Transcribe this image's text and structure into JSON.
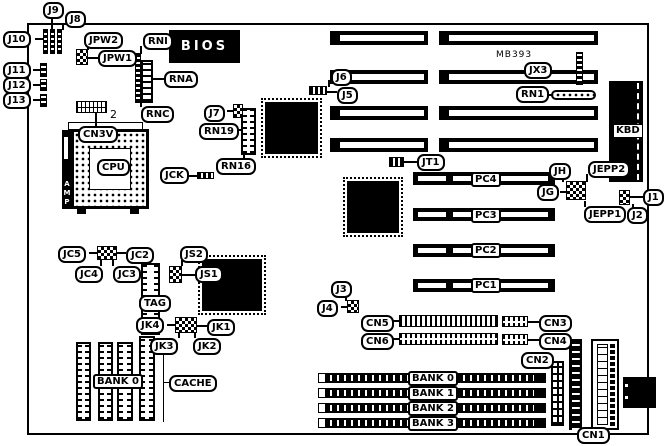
{
  "board": {
    "model_text": "MB393",
    "cn3v_pin_count": "2"
  },
  "chips": {
    "bios": "BIOS",
    "cpu": "CPU",
    "kbd": "KBD",
    "amp": "AMP"
  },
  "callouts": {
    "j1": "J1",
    "j2": "J2",
    "j3": "J3",
    "j4": "J4",
    "j5": "J5",
    "j6": "J6",
    "j7": "J7",
    "j8": "J8",
    "j9": "J9",
    "j10": "J10",
    "j11": "J11",
    "j12": "J12",
    "j13": "J13",
    "jpw1": "JPW1",
    "jpw2": "JPW2",
    "rni": "RNI",
    "rna": "RNA",
    "rnc": "RNC",
    "rn19": "RN19",
    "rn16": "RN16",
    "rn1": "RN1",
    "cn3v": "CN3V",
    "jck": "JCK",
    "jx3": "JX3",
    "jt1": "JT1",
    "jh": "JH",
    "jg": "JG",
    "jepp1": "JEPP1",
    "jepp2": "JEPP2",
    "jc2": "JC2",
    "jc3": "JC3",
    "jc4": "JC4",
    "jc5": "JC5",
    "js1": "JS1",
    "js2": "JS2",
    "tag": "TAG",
    "jk1": "JK1",
    "jk2": "JK2",
    "jk3": "JK3",
    "jk4": "JK4",
    "cn1": "CN1",
    "cn2": "CN2",
    "cn3": "CN3",
    "cn4": "CN4",
    "cn5": "CN5",
    "cn6": "CN6"
  },
  "cache": {
    "bank_label": "BANK 0",
    "cache_label": "CACHE"
  },
  "slots": {
    "pci": [
      "PC4",
      "PC3",
      "PC2",
      "PC1"
    ],
    "simm": [
      "BANK 0",
      "BANK 1",
      "BANK 2",
      "BANK 3"
    ]
  }
}
